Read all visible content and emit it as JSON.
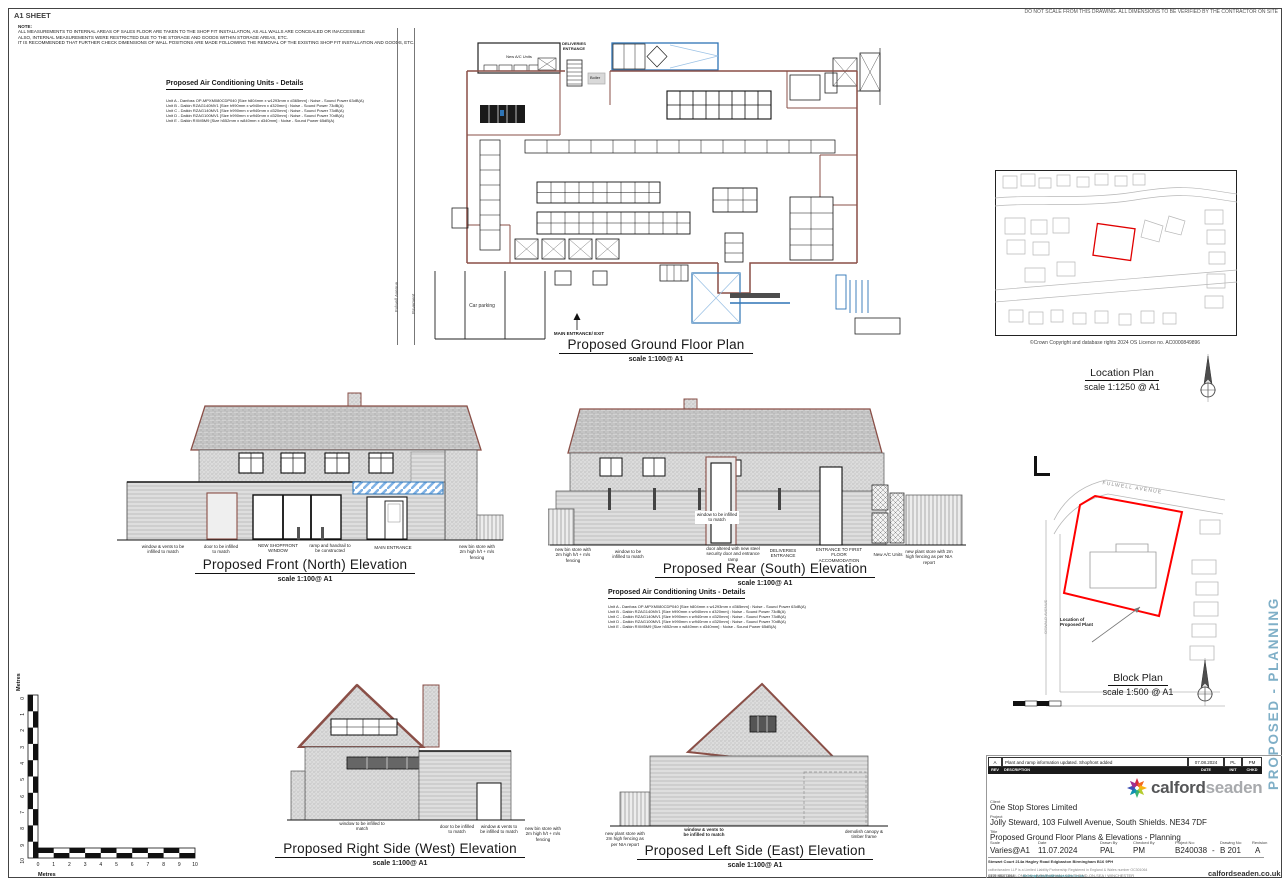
{
  "sheet": {
    "size_label": "A1 SHEET",
    "note_heading": "NOTE:",
    "notes": [
      "ALL MEASUREMENTS TO INTERNAL AREAS OF SALES FLOOR ARE TAKEN TO THE SHOP FIT INSTALLATION, AS ALL WALLS ARE CONCEALED OR INACCESSIBLE",
      "ALSO, INTERNAL MEASUREMENTS WERE RESTRICTED DUE TO THE STORAGE AND GOODS WITHIN STORAGE AREAS, ETC.",
      "IT IS RECOMMENDED THAT FURTHER CHECK DIMENSIONS OF WALL POSITIONS ARE MADE FOLLOWING THE REMOVAL OF THE EXISTING SHOP FIT INSTALLATION AND GOODS, ETC."
    ],
    "disclaimer": "DO NOT SCALE FROM THIS DRAWING. ALL DIMENSIONS TO BE VERIFIED BY THE CONTRACTOR ON SITE",
    "watermark": "PROPOSED - PLANNING"
  },
  "ac_details": {
    "heading": "Proposed Air Conditioning Units - Details",
    "units": [
      "Unit A - Danfoss OP-MPXM080CDP040 [Size h804mm x w1293mm x d365mm] : Noise - Sound Power 63dB(A)",
      "Unit B - Daikin RZAG140MV1 [Size h990mm x w940mm x d320mm] : Noise - Sound Power 73dB(A)",
      "Unit C - Daikin RZAG140MV1 [Size h990mm x w940mm x d320mm] : Noise - Sound Power 73dB(A)",
      "Unit D - Daikin RZAG100MV1 [Size h990mm x w940mm x d320mm] : Noise - Sound Power 70dB(A)",
      "Unit E - Daikin RXM5M9 [Size h552mm x w840mm x d340mm] : Noise - Sound Power 65dB(A)"
    ]
  },
  "floor_plan": {
    "title": "Proposed Ground Floor Plan",
    "scale": "scale 1:100@ A1",
    "labels": {
      "new_ac_units": "New A/C Units",
      "deliveries": "DELIVERIES ENTRANCE",
      "boiler": "Boiler",
      "car_parking": "Car parking",
      "main_entrance": "MAIN ENTRANCE/ EXIT",
      "street": "Fulwell Avenue",
      "pavement": "Pavement"
    }
  },
  "location_plan": {
    "title": "Location Plan",
    "scale": "scale 1:1250 @ A1",
    "copyright": "©Crown Copyright and database rights 2024 OS Licence no. AC0000849896"
  },
  "block_plan": {
    "title": "Block Plan",
    "scale": "scale 1:500 @ A1",
    "street": "FULWELL AVENUE",
    "side_street": "OSWALD AVENUE",
    "plant_label": "Location of Proposed Plant"
  },
  "elevations": {
    "front": {
      "title": "Proposed Front (North) Elevation",
      "scale": "scale 1:100@ A1",
      "annotations": [
        "window & vents to be infilled to match",
        "door to be infilled to match",
        "NEW SHOPFRONT WINDOW",
        "ramp and handrail to be constructed",
        "MAIN ENTRANCE",
        "new bin store with 2m high h/t + m/s fencing"
      ]
    },
    "rear": {
      "title": "Proposed Rear (South) Elevation",
      "scale": "scale 1:100@ A1",
      "annotations": [
        "new bin store with 2m high h/t + m/s fencing",
        "window to be infilled to match",
        "window to be infilled to match",
        "door altered with new steel security door and entrance ramp",
        "DELIVERIES ENTRANCE",
        "ENTRANCE TO FIRST FLOOR ACCOMMODATION",
        "New A/C Units",
        "new plant store with 2m high fencing as per NIA report"
      ]
    },
    "west": {
      "title": "Proposed Right Side (West) Elevation",
      "scale": "scale 1:100@ A1",
      "annotations": [
        "window to be infilled to match",
        "door to be infilled to match",
        "window & vents to be infilled to match",
        "new bin store with 2m high h/t + m/s fencing"
      ]
    },
    "east": {
      "title": "Proposed Left Side (East) Elevation",
      "scale": "scale 1:100@ A1",
      "annotations": [
        "new plant store with 2m high fencing as per NIA report",
        "window & vents to be infilled to match",
        "demolish canopy & timber frame"
      ]
    }
  },
  "scale_bar": {
    "unit": "Metres",
    "ticks": [
      "0",
      "1",
      "2",
      "3",
      "4",
      "5",
      "6",
      "7",
      "8",
      "9",
      "10"
    ]
  },
  "title_block": {
    "revision": {
      "rev": "A",
      "description": "Plant and ramp information updated. Shopfront added",
      "date": "07.08.2024",
      "init": "PL",
      "chkd": "PM"
    },
    "revision_header": {
      "rev": "REV",
      "description": "DESCRIPTION",
      "date": "DATE",
      "init": "INIT",
      "chkd": "CHKD"
    },
    "logo_part1": "calford",
    "logo_part2": "seaden",
    "client_label": "Client",
    "client": "One Stop Stores Limited",
    "project_label": "Project",
    "project": "Jolly Steward, 103 Fulwell Avenue, South Shields. NE34 7DF",
    "title_label": "Title",
    "title": "Proposed Ground Floor Plans & Elevations - Planning",
    "scale_label": "Scale",
    "scale": "Varies@A1",
    "date_label": "Date",
    "date": "11.07.2024",
    "drawn_label": "Drawn By",
    "drawn": "PAL",
    "checked_label": "Checked By",
    "checked": "PM",
    "project_no_label": "Project No:",
    "project_no": "B240038",
    "separator": "-",
    "drawing_no_label": "Drawing No:",
    "drawing_no": "B 201",
    "revision_label": "Revision",
    "revision_value": "A",
    "address": "Stewart Court 214a Hagley Road Edgbaston Birmingham B16 9PH",
    "phone": "0121 454 1688",
    "email": "birmingham@calfordseaden.co.uk",
    "registration": "calfordseaden LLP is a Limited Liability Partnership Registered in England & Wales number OC301064",
    "offices": "ORPINGTON  |  LONDON  |  BIRMINGHAM  |  SOUTHEND-ON-SEA  |  WINCHESTER",
    "website": "calfordseaden.co.uk"
  },
  "colors": {
    "wall_brown": "#8a4f47",
    "accent_blue": "#2e74b5",
    "light_blue": "#9dc3e6",
    "watermark_blue": "#7fafc7",
    "outline_red": "#ff0000",
    "map_gray": "#b8b8b8",
    "logo_colors": [
      "#d7263d",
      "#f46a1f",
      "#f9b410",
      "#b5cc2e",
      "#3bb273",
      "#1193b0",
      "#3f51b5",
      "#a3308f"
    ]
  }
}
